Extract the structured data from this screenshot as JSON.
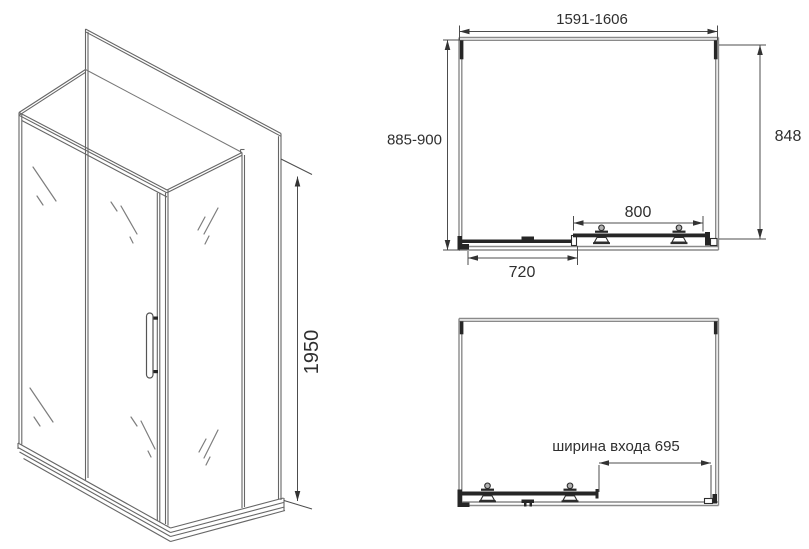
{
  "drawing": {
    "type": "technical-drawing",
    "background": "#ffffff",
    "line_color": "#6b6b6b",
    "frame_color": "#8a8a8a",
    "dark_color": "#262626",
    "dimension_color": "#4d4d4d",
    "text_color": "#2f2f2f"
  },
  "isometric_view": {
    "height_dimension": "1950"
  },
  "plan_top_view": {
    "overall_width": "1591-1606",
    "left_depth": "885-900",
    "right_depth": "848",
    "door_dimension": "800",
    "fixed_panel_dimension": "720"
  },
  "plan_open_view": {
    "entrance_width": "ширина входа 695"
  }
}
